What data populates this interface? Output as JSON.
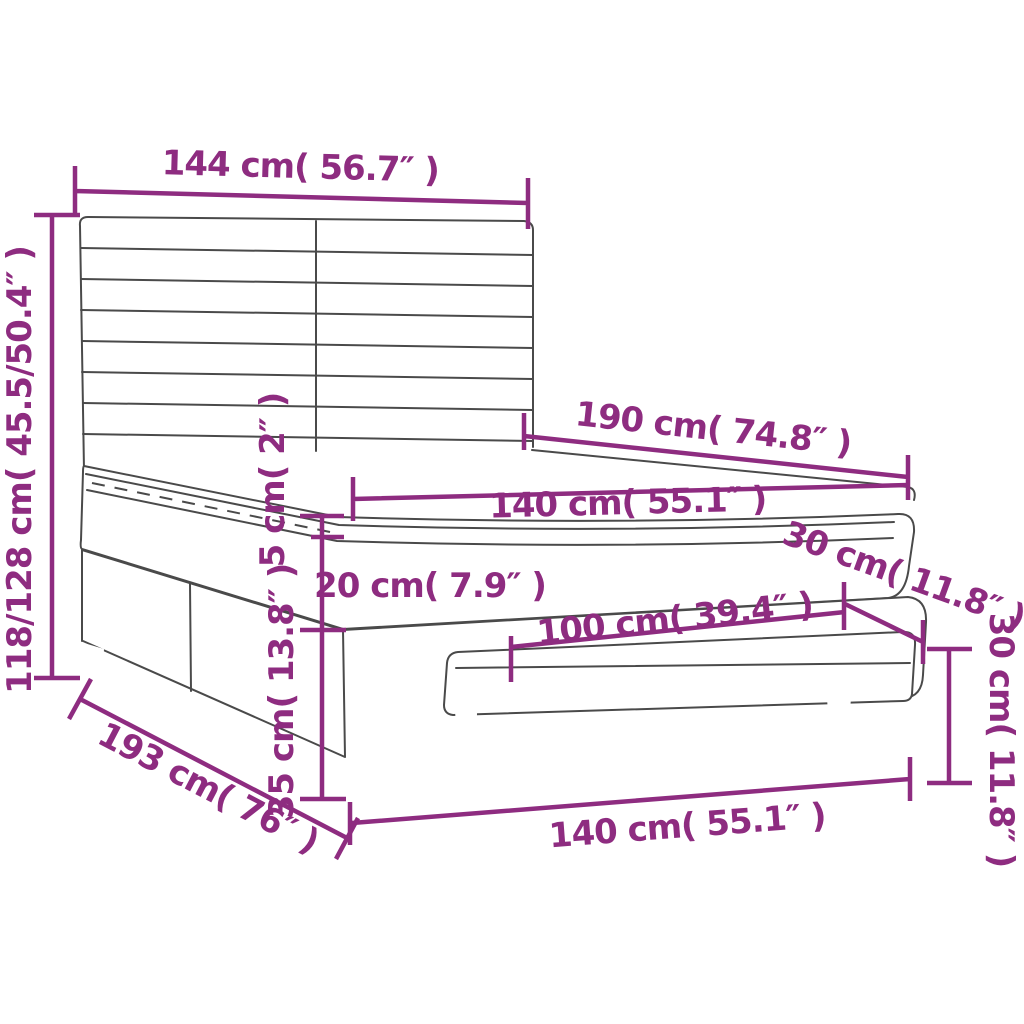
{
  "diagram": {
    "subject": "box-spring-bed-with-headboard-and-bench-dimension-diagram",
    "colors": {
      "dimension": "#8e2c80",
      "drawing": "#4a4a4a",
      "background": "#ffffff"
    },
    "dimensions": [
      {
        "id": "headboard-width",
        "label": "144 cm( 56.7″ )"
      },
      {
        "id": "bed-height",
        "label": "118/128 cm( 45.5/50.4″ )"
      },
      {
        "id": "bed-length",
        "label": "190 cm( 74.8″ )"
      },
      {
        "id": "mattress-width",
        "label": "140 cm( 55.1″ )"
      },
      {
        "id": "topper-height",
        "label": "5 cm( 2″ )"
      },
      {
        "id": "mattress-height",
        "label": "20 cm( 7.9″ )"
      },
      {
        "id": "box-spring-height",
        "label": "30 cm( 11.8″ )"
      },
      {
        "id": "base-height",
        "label": "35 cm( 13.8″ )"
      },
      {
        "id": "bench-length",
        "label": "100 cm( 39.4″ )"
      },
      {
        "id": "bench-height",
        "label": "30 cm( 11.8″ )"
      },
      {
        "id": "frame-length",
        "label": "193 cm( 76″ )"
      },
      {
        "id": "bed-width",
        "label": "140 cm( 55.1″ )"
      }
    ]
  }
}
